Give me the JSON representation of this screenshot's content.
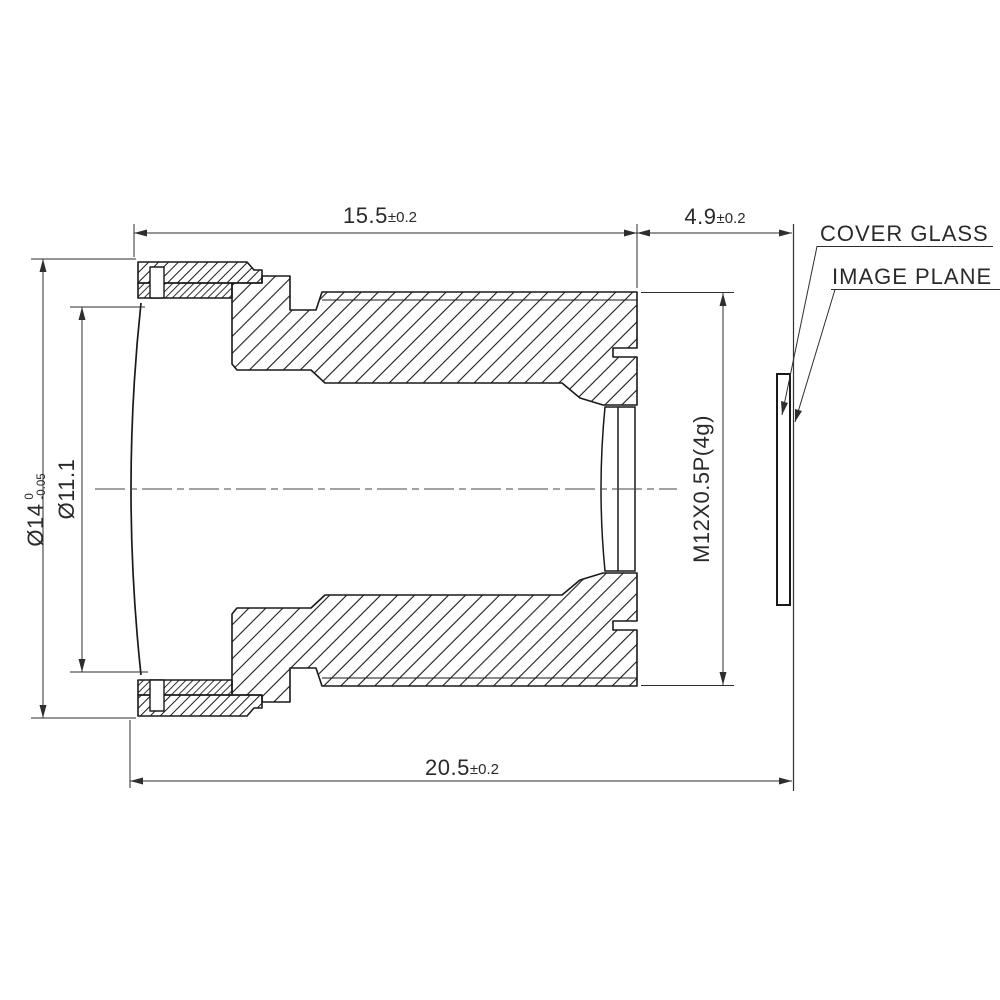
{
  "dimensions": {
    "barrel_length": {
      "value": "15.5",
      "tol": "±0.2"
    },
    "back_focal_distance": {
      "value": "4.9",
      "tol": "±0.2"
    },
    "total_length": {
      "value": "20.5",
      "tol": "±0.2"
    },
    "outer_diameter": {
      "value": "Ø14",
      "tol_upper": "0",
      "tol_lower": "-0.05"
    },
    "front_aperture_diameter": {
      "value": "Ø11.1"
    },
    "mount_thread": {
      "value": "M12X0.5P(4g)"
    }
  },
  "labels": {
    "cover_glass": "COVER GLASS",
    "image_plane": "IMAGE PLANE"
  },
  "colors": {
    "line": "#1a1a1a",
    "annotation": "#2e2e2e",
    "background": "#ffffff"
  }
}
